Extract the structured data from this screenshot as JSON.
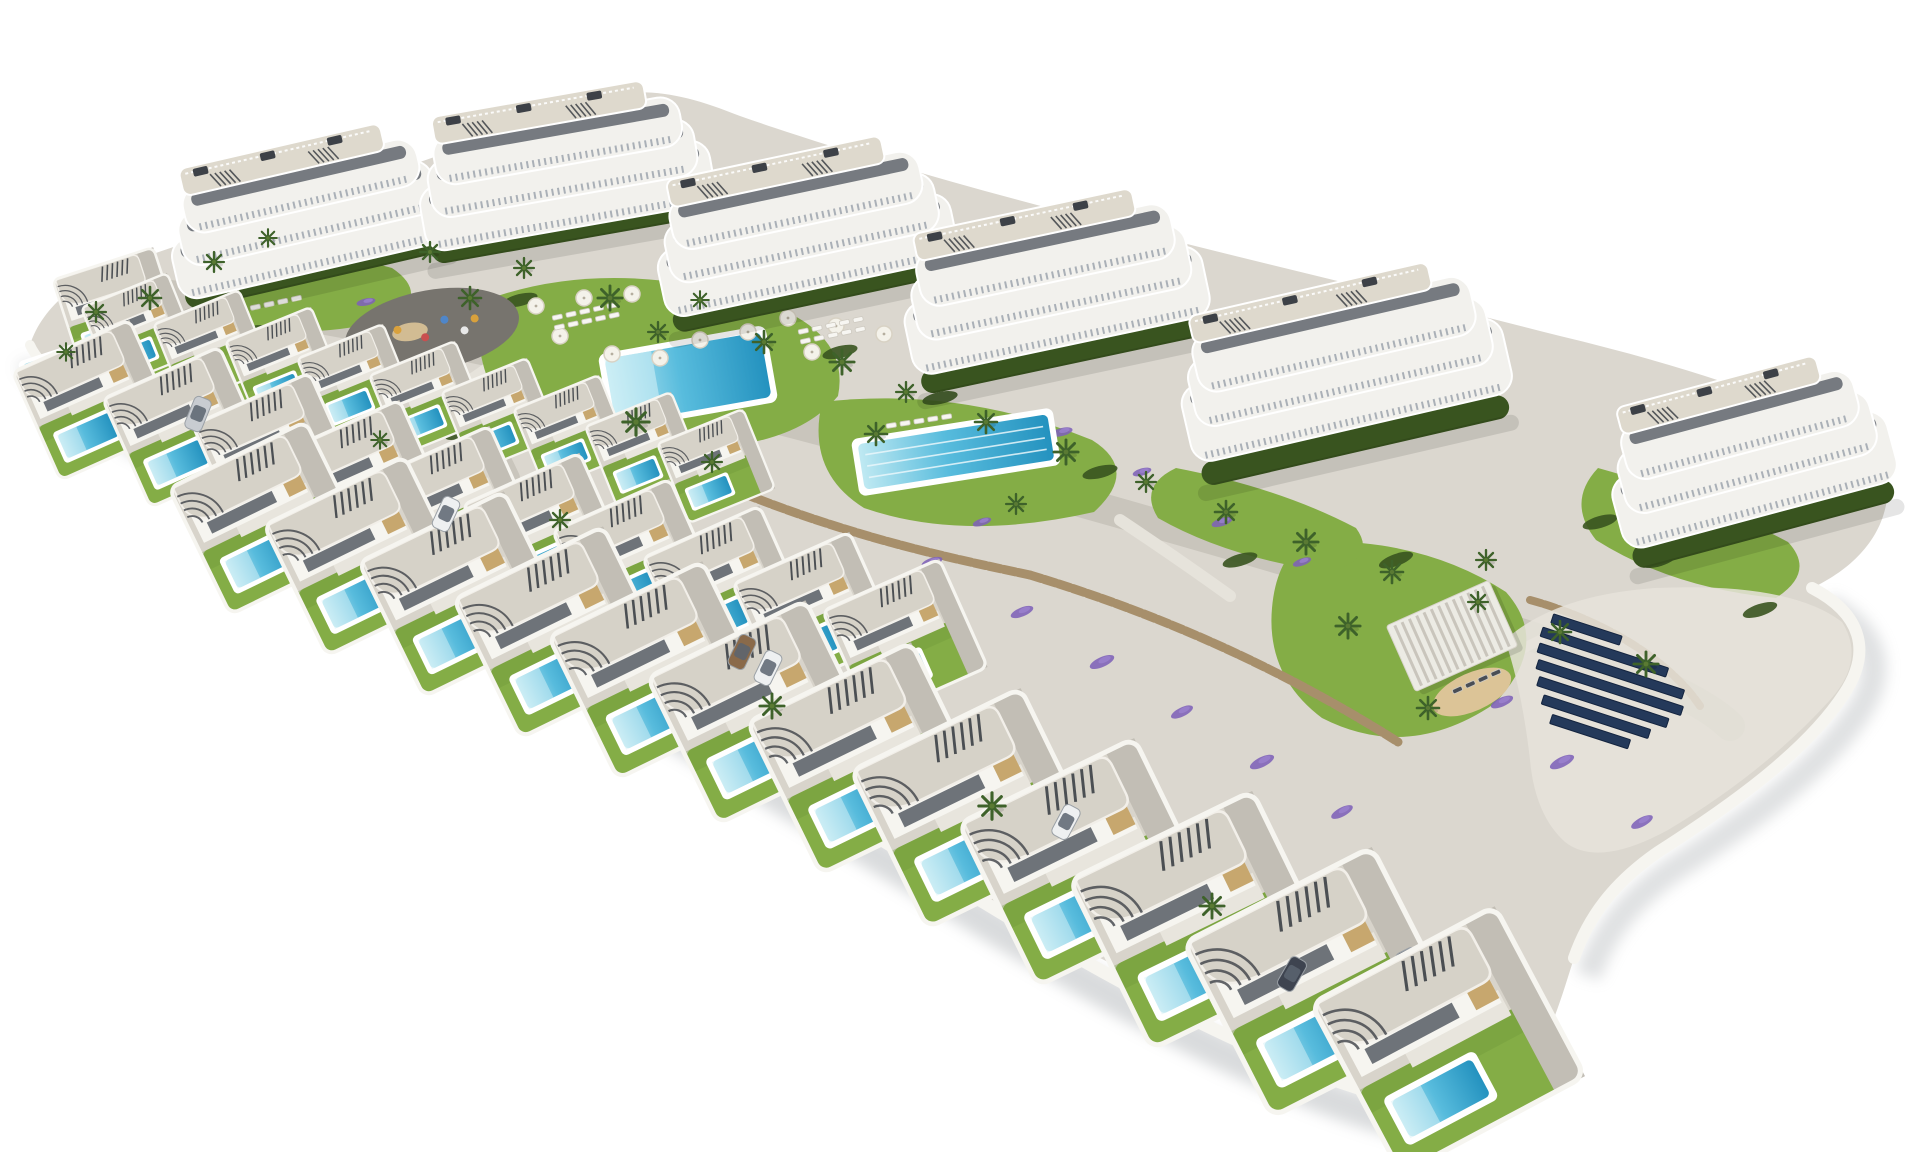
{
  "scene": {
    "kind": "aerial-3d-architectural-render",
    "subject": "residential development with apartment blocks, villas with private pools, community pools and solar panels",
    "width": 1920,
    "height": 1152
  },
  "palette": {
    "bg": "#ffffff",
    "plate": "#dbd7cf",
    "road": "#c9c5bc",
    "path": "#e6e3db",
    "plot": "#d8d4cb",
    "drive": "#c2beb5",
    "terrace": "#e8e5dd",
    "wall_white": "#f6f5f0",
    "roof": "#d6d2c8",
    "roof_deck": "#ded9cd",
    "bldg": "#f2f1ed",
    "glass": "#565c64",
    "balcony": "#aab0b7",
    "slat": "#3d4147",
    "tan": "#c7a76e",
    "lawn": "#84ad46",
    "lawn_dark": "#6d9839",
    "hedge": "#39541f",
    "palm": "#3e622a",
    "stone": "#a78f6b",
    "stone_dark": "#84704f",
    "flower": "#7e62b8",
    "pool_light": "#bfe9f2",
    "pool_mid": "#58bcdd",
    "pool_deep": "#2492bf",
    "navy": "#24395a",
    "sand": "#dcc497",
    "shadow": "#a6aaae",
    "asphalt": "#77746e",
    "car_white": "#eef0f1",
    "car_silver": "#c8ccd1",
    "car_dark": "#3e4450",
    "car_bronze": "#8a6a4a"
  },
  "buildings": [
    {
      "x": 310,
      "y": 225,
      "a": -13,
      "w": 240,
      "h": 120
    },
    {
      "x": 565,
      "y": 182,
      "a": -10,
      "w": 250,
      "h": 126
    },
    {
      "x": 805,
      "y": 243,
      "a": -12,
      "w": 255,
      "h": 132
    },
    {
      "x": 1055,
      "y": 300,
      "a": -12,
      "w": 260,
      "h": 140
    },
    {
      "x": 1345,
      "y": 382,
      "a": -13,
      "w": 285,
      "h": 150
    },
    {
      "x": 1752,
      "y": 470,
      "a": -15,
      "w": 240,
      "h": 142
    }
  ],
  "villas": [
    {
      "x": 118,
      "y": 310,
      "s": 0.66,
      "a": -18
    },
    {
      "x": 140,
      "y": 330,
      "s": 0.58,
      "a": -22
    },
    {
      "x": 212,
      "y": 347,
      "s": 0.58,
      "a": -22
    },
    {
      "x": 284,
      "y": 364,
      "s": 0.58,
      "a": -22
    },
    {
      "x": 356,
      "y": 381,
      "s": 0.58,
      "a": -22
    },
    {
      "x": 428,
      "y": 398,
      "s": 0.58,
      "a": -22
    },
    {
      "x": 500,
      "y": 415,
      "s": 0.58,
      "a": -22
    },
    {
      "x": 572,
      "y": 432,
      "s": 0.58,
      "a": -22
    },
    {
      "x": 644,
      "y": 449,
      "s": 0.58,
      "a": -22
    },
    {
      "x": 716,
      "y": 466,
      "s": 0.58,
      "a": -22
    },
    {
      "x": 95,
      "y": 400,
      "s": 0.8,
      "a": -24
    },
    {
      "x": 185,
      "y": 427,
      "s": 0.8,
      "a": -24,
      "car": "white"
    },
    {
      "x": 275,
      "y": 453,
      "s": 0.8,
      "a": -24
    },
    {
      "x": 365,
      "y": 480,
      "s": 0.8,
      "a": -24
    },
    {
      "x": 455,
      "y": 506,
      "s": 0.8,
      "a": -24,
      "car": "silver"
    },
    {
      "x": 545,
      "y": 533,
      "s": 0.8,
      "a": -24
    },
    {
      "x": 635,
      "y": 559,
      "s": 0.8,
      "a": -24
    },
    {
      "x": 725,
      "y": 586,
      "s": 0.8,
      "a": -24,
      "car": "white"
    },
    {
      "x": 815,
      "y": 612,
      "s": 0.8,
      "a": -24
    },
    {
      "x": 905,
      "y": 639,
      "s": 0.8,
      "a": -24
    },
    {
      "x": 268,
      "y": 518,
      "s": 0.95,
      "a": -26
    },
    {
      "x": 366,
      "y": 556,
      "s": 0.98,
      "a": -26
    },
    {
      "x": 464,
      "y": 594,
      "s": 1.01,
      "a": -26,
      "car": "dark"
    },
    {
      "x": 562,
      "y": 632,
      "s": 1.04,
      "a": -26
    },
    {
      "x": 660,
      "y": 670,
      "s": 1.07,
      "a": -26
    },
    {
      "x": 762,
      "y": 712,
      "s": 1.1,
      "a": -26,
      "car": "white"
    },
    {
      "x": 866,
      "y": 758,
      "s": 1.14,
      "a": -26
    },
    {
      "x": 974,
      "y": 808,
      "s": 1.18,
      "a": -26
    },
    {
      "x": 1086,
      "y": 862,
      "s": 1.22,
      "a": -26,
      "car": "silver"
    },
    {
      "x": 1202,
      "y": 920,
      "s": 1.27,
      "a": -26
    },
    {
      "x": 1322,
      "y": 982,
      "s": 1.32,
      "a": -27,
      "car": "dark"
    },
    {
      "x": 1448,
      "y": 1040,
      "s": 1.3,
      "a": -28
    }
  ],
  "pools": {
    "main": {
      "x": 688,
      "y": 378,
      "w": 158,
      "h": 66,
      "a": -10
    },
    "lap": {
      "x": 956,
      "y": 452,
      "w": 192,
      "h": 46,
      "a": -9,
      "lanes": 3
    },
    "clubhouse": {
      "x": 54,
      "y": 368,
      "w": 58,
      "h": 26,
      "a": -18
    }
  },
  "playground": {
    "x": 432,
    "y": 330,
    "rx": 88,
    "ry": 40,
    "a": -10,
    "items": [
      [
        -34,
        -6,
        "#d9a13c"
      ],
      [
        -8,
        6,
        "#c94f4f"
      ],
      [
        14,
        -8,
        "#4f86c9"
      ],
      [
        32,
        6,
        "#e8e8e8"
      ],
      [
        -52,
        4,
        "#6fae4e"
      ],
      [
        44,
        -4,
        "#d9a13c"
      ]
    ]
  },
  "pergola": {
    "x": 1452,
    "y": 636,
    "a": -24,
    "w": 112,
    "h": 72
  },
  "sand": {
    "x": 1472,
    "y": 692,
    "a": -24,
    "rx": 42,
    "ry": 19
  },
  "solar": {
    "x": 1548,
    "y": 612,
    "a": 18,
    "gap": 16,
    "rowh": 9.5,
    "rows": [
      {
        "dx": 6,
        "len": 72
      },
      {
        "dx": 0,
        "len": 132
      },
      {
        "dx": 2,
        "len": 152
      },
      {
        "dx": 6,
        "len": 152
      },
      {
        "dx": 12,
        "len": 136
      },
      {
        "dx": 22,
        "len": 112
      },
      {
        "dx": 36,
        "len": 82
      }
    ]
  },
  "palms": [
    [
      150,
      298,
      1.0
    ],
    [
      214,
      262,
      0.9
    ],
    [
      268,
      238,
      0.8
    ],
    [
      430,
      252,
      0.9
    ],
    [
      470,
      298,
      1.0
    ],
    [
      524,
      268,
      0.9
    ],
    [
      610,
      298,
      1.1
    ],
    [
      658,
      332,
      0.9
    ],
    [
      700,
      300,
      0.8
    ],
    [
      764,
      342,
      1.0
    ],
    [
      842,
      362,
      1.1
    ],
    [
      906,
      392,
      0.9
    ],
    [
      986,
      422,
      1.0
    ],
    [
      1066,
      452,
      1.1
    ],
    [
      1146,
      482,
      0.9
    ],
    [
      1226,
      512,
      1.0
    ],
    [
      1306,
      542,
      1.1
    ],
    [
      1392,
      572,
      1.0
    ],
    [
      1478,
      602,
      0.9
    ],
    [
      1560,
      632,
      1.0
    ],
    [
      1646,
      664,
      1.1
    ],
    [
      636,
      422,
      1.2
    ],
    [
      712,
      462,
      0.9
    ],
    [
      876,
      434,
      1.0
    ],
    [
      1016,
      504,
      0.9
    ],
    [
      1348,
      626,
      1.1
    ],
    [
      1428,
      708,
      1.0
    ],
    [
      1486,
      560,
      0.9
    ],
    [
      96,
      312,
      0.9
    ],
    [
      66,
      352,
      0.8
    ],
    [
      772,
      706,
      1.1
    ],
    [
      992,
      806,
      1.2
    ],
    [
      1212,
      906,
      1.1
    ],
    [
      560,
      520,
      0.9
    ],
    [
      380,
      440,
      0.8
    ]
  ],
  "flowers": [
    [
      162,
      336,
      1,
      -20
    ],
    [
      242,
      376,
      1.2,
      -20
    ],
    [
      322,
      416,
      1,
      -22
    ],
    [
      402,
      456,
      1.1,
      -24
    ],
    [
      302,
      350,
      0.9,
      -15
    ],
    [
      366,
      302,
      0.8,
      -12
    ],
    [
      482,
      470,
      1,
      -22
    ],
    [
      562,
      508,
      1.1,
      -24
    ],
    [
      642,
      472,
      0.9,
      -18
    ],
    [
      702,
      540,
      1,
      -24
    ],
    [
      762,
      572,
      1.1,
      -24
    ],
    [
      842,
      610,
      1,
      -26
    ],
    [
      932,
      562,
      0.9,
      -18
    ],
    [
      1022,
      612,
      1,
      -22
    ],
    [
      1102,
      662,
      1.1,
      -24
    ],
    [
      1182,
      712,
      1,
      -26
    ],
    [
      1262,
      762,
      1.1,
      -26
    ],
    [
      1342,
      812,
      1,
      -28
    ],
    [
      1422,
      642,
      0.9,
      -22
    ],
    [
      1502,
      702,
      1,
      -24
    ],
    [
      1562,
      762,
      1.1,
      -26
    ],
    [
      1642,
      822,
      1,
      -28
    ],
    [
      1682,
      472,
      0.9,
      -16
    ],
    [
      1742,
      522,
      1,
      -18
    ],
    [
      902,
      482,
      0.9,
      -16
    ],
    [
      982,
      522,
      0.8,
      -18
    ],
    [
      1062,
      432,
      0.9,
      -14
    ],
    [
      1142,
      472,
      0.8,
      -16
    ],
    [
      1222,
      522,
      0.9,
      -18
    ],
    [
      1302,
      562,
      0.8,
      -20
    ]
  ],
  "hedges": [
    [
      520,
      300,
      -14
    ],
    [
      840,
      352,
      -14
    ],
    [
      700,
      452,
      -16
    ],
    [
      1100,
      472,
      -14
    ],
    [
      1396,
      560,
      -20
    ],
    [
      1600,
      522,
      -16
    ],
    [
      252,
      332,
      -12
    ],
    [
      462,
      432,
      -18
    ],
    [
      940,
      398,
      -12
    ],
    [
      1240,
      560,
      -16
    ],
    [
      1660,
      560,
      -18
    ],
    [
      1760,
      610,
      -18
    ]
  ],
  "umbrellas": [
    [
      536,
      306
    ],
    [
      584,
      298
    ],
    [
      632,
      294
    ],
    [
      788,
      318
    ],
    [
      836,
      326
    ],
    [
      884,
      334
    ],
    [
      700,
      340
    ],
    [
      748,
      332
    ],
    [
      612,
      354
    ],
    [
      660,
      358
    ],
    [
      560,
      336
    ],
    [
      812,
      352
    ]
  ],
  "lounger_clusters": [
    {
      "x": 552,
      "y": 316,
      "a": -12,
      "rows": 2,
      "cols": 5
    },
    {
      "x": 798,
      "y": 330,
      "a": -12,
      "rows": 2,
      "cols": 5
    },
    {
      "x": 886,
      "y": 424,
      "a": -9,
      "rows": 1,
      "cols": 5
    },
    {
      "x": 250,
      "y": 306,
      "a": -12,
      "rows": 1,
      "cols": 4
    },
    {
      "x": 1452,
      "y": 690,
      "a": -24,
      "rows": 1,
      "cols": 4,
      "dark": true
    }
  ],
  "street_cars": [
    {
      "x": 446,
      "y": 514,
      "a": 25,
      "c": "white"
    },
    {
      "x": 742,
      "y": 652,
      "a": 26,
      "c": "bronze"
    },
    {
      "x": 768,
      "y": 668,
      "a": 26,
      "c": "white"
    },
    {
      "x": 1066,
      "y": 822,
      "a": 28,
      "c": "white"
    },
    {
      "x": 1292,
      "y": 974,
      "a": 30,
      "c": "dark"
    },
    {
      "x": 198,
      "y": 414,
      "a": 22,
      "c": "silver"
    }
  ]
}
